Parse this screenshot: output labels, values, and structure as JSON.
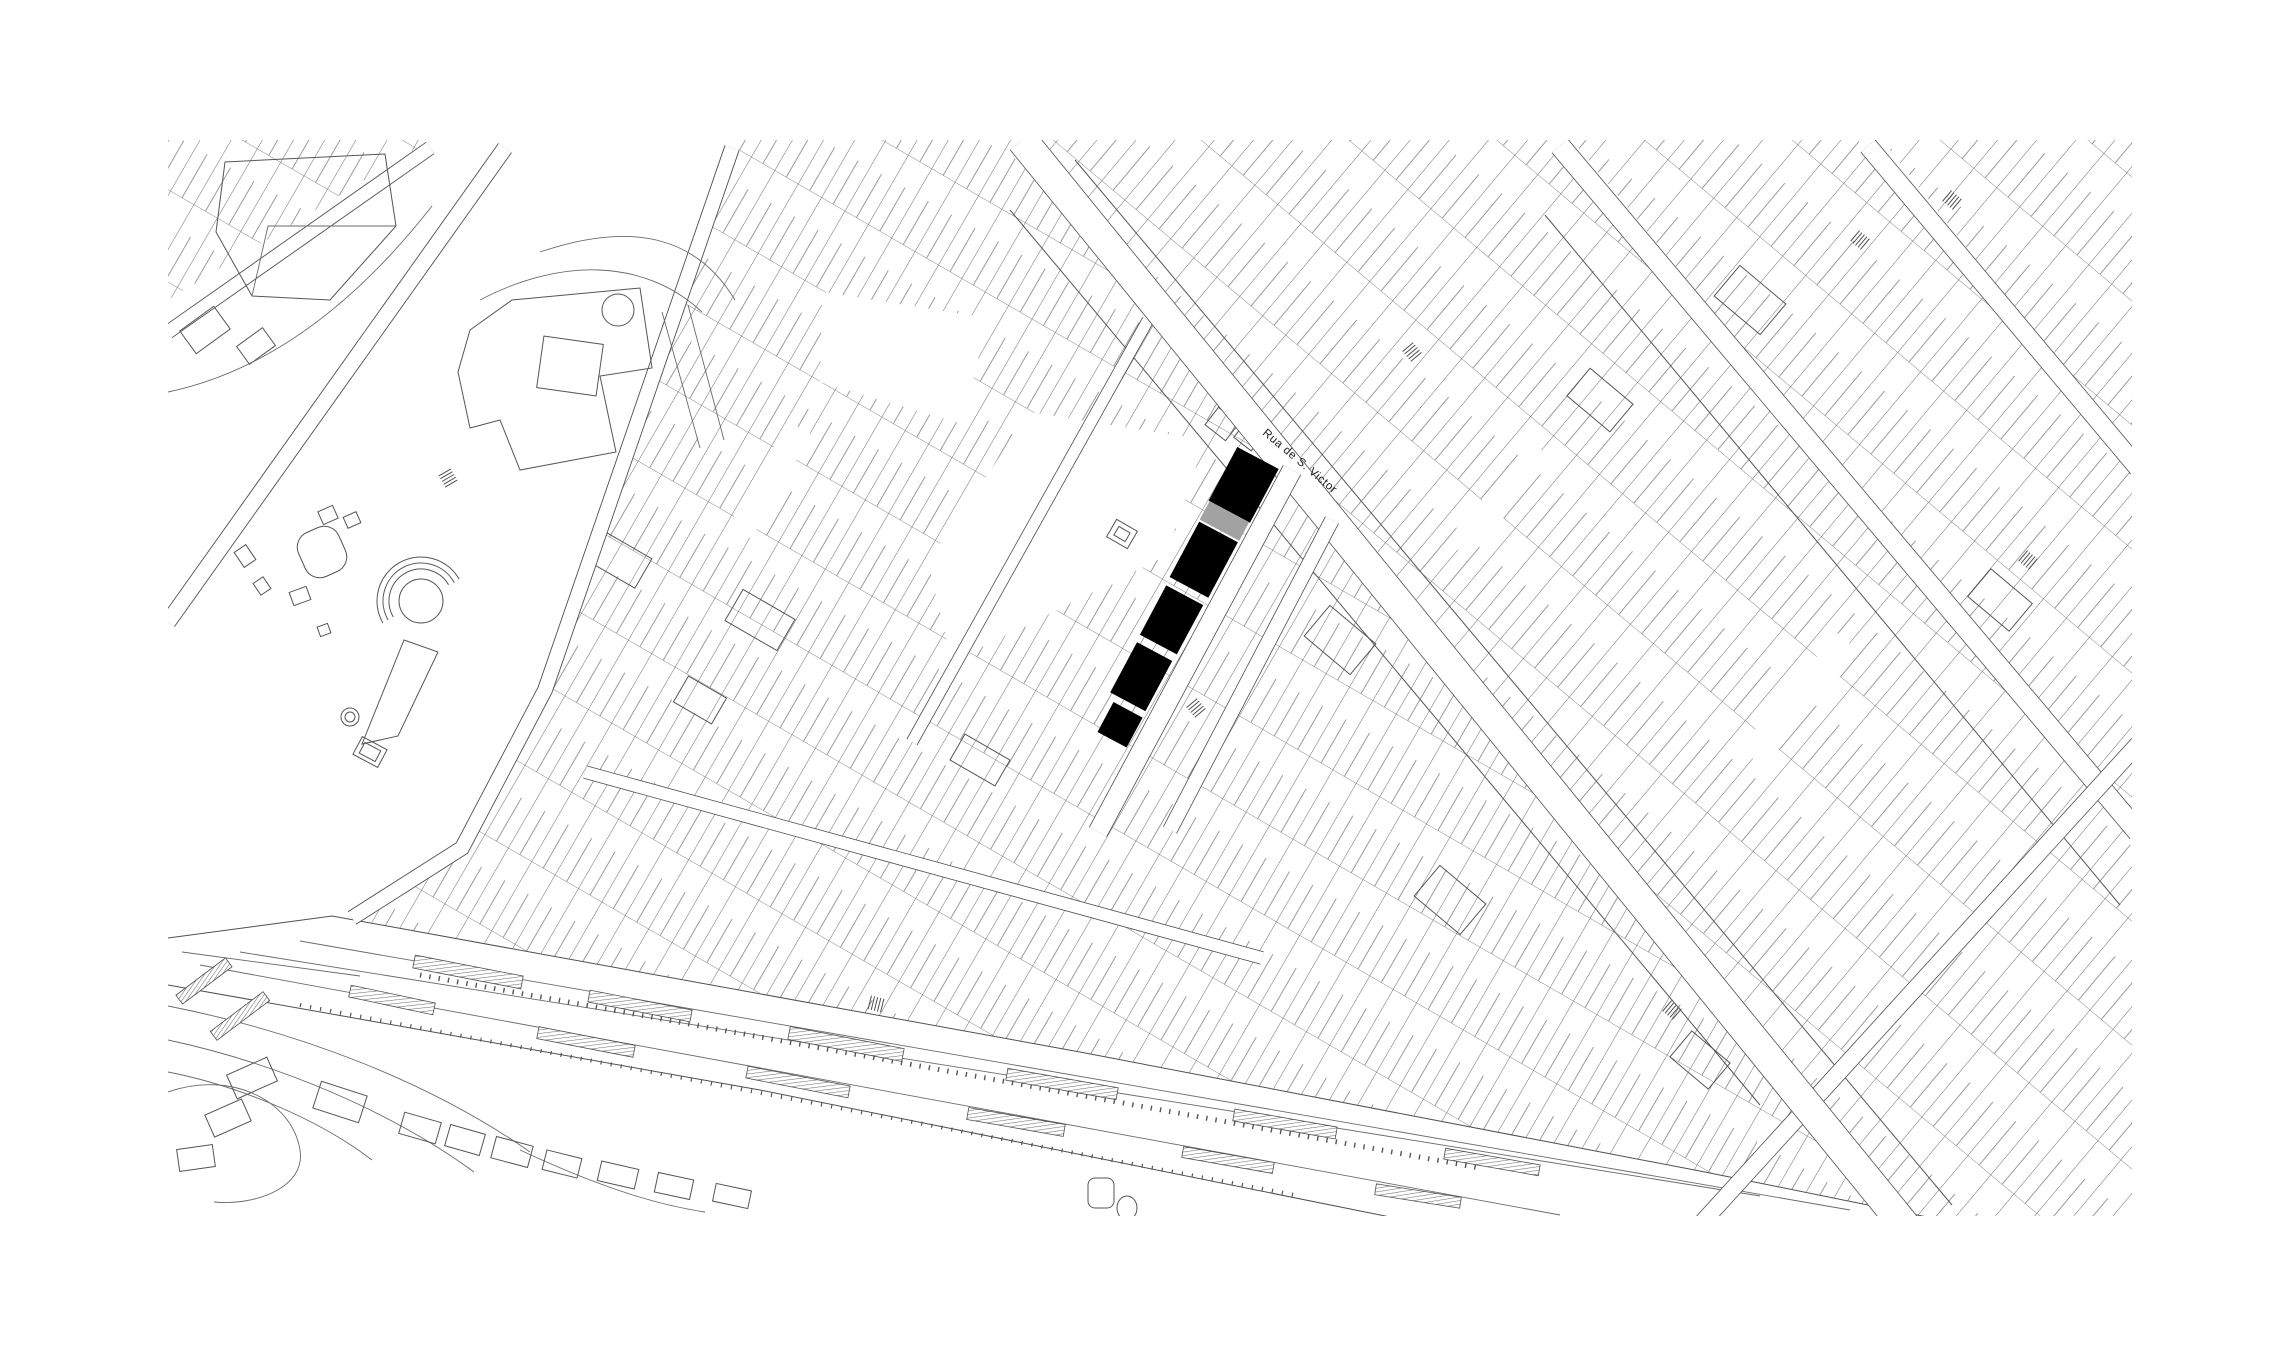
{
  "document": {
    "kind": "site-location-plan",
    "background": "#ffffff"
  },
  "map": {
    "line_color": "#4f4f4f",
    "parcel_line_color": "#5c5c5c",
    "terrain_line_color": "#6a6a6a",
    "street_label": {
      "text": "Rua de S. Victor",
      "x": 1262,
      "y": 434,
      "rotation": 40,
      "font_size": 11.5,
      "letter_spacing": 0.6,
      "color": "#1b1b1b"
    },
    "highlight_strip": {
      "black": "#000000",
      "gray": "#a2a2a2",
      "origin": {
        "x": 1258,
        "y": 458
      },
      "dir": {
        "x": -0.47,
        "y": 0.88
      },
      "perp": {
        "x": 0.88,
        "y": 0.47
      },
      "segments": [
        {
          "s0": 0,
          "s1": 61,
          "w": 47,
          "off": 0,
          "tone": "black"
        },
        {
          "s0": 61,
          "s1": 82,
          "w": 45,
          "off": 0,
          "tone": "gray"
        },
        {
          "s0": 84,
          "s1": 147,
          "w": 44,
          "off": 0,
          "tone": "black"
        },
        {
          "s0": 156,
          "s1": 212,
          "w": 42,
          "off": 0,
          "tone": "black"
        },
        {
          "s0": 220,
          "s1": 277,
          "w": 40,
          "off": 0,
          "tone": "black"
        },
        {
          "s0": 284,
          "s1": 318,
          "w": 33,
          "off": 4,
          "tone": "black"
        }
      ]
    },
    "railway_platforms": {
      "hatch_color": "#6f6f6f",
      "outline_color": "#4f4f4f",
      "items": [
        {
          "x": 468,
          "y": 972,
          "len": 110,
          "w": 13,
          "rot": 11
        },
        {
          "x": 640,
          "y": 1006,
          "len": 104,
          "w": 12,
          "rot": 11
        },
        {
          "x": 846,
          "y": 1044,
          "len": 116,
          "w": 13,
          "rot": 11
        },
        {
          "x": 1062,
          "y": 1084,
          "len": 112,
          "w": 12,
          "rot": 10
        },
        {
          "x": 1285,
          "y": 1124,
          "len": 104,
          "w": 12,
          "rot": 10
        },
        {
          "x": 1492,
          "y": 1162,
          "len": 96,
          "w": 11,
          "rot": 10
        },
        {
          "x": 392,
          "y": 1000,
          "len": 86,
          "w": 12,
          "rot": 12
        },
        {
          "x": 586,
          "y": 1042,
          "len": 98,
          "w": 12,
          "rot": 11
        },
        {
          "x": 798,
          "y": 1082,
          "len": 104,
          "w": 12,
          "rot": 11
        },
        {
          "x": 1016,
          "y": 1122,
          "len": 98,
          "w": 12,
          "rot": 10
        },
        {
          "x": 1228,
          "y": 1160,
          "len": 92,
          "w": 11,
          "rot": 10
        },
        {
          "x": 1418,
          "y": 1196,
          "len": 86,
          "w": 11,
          "rot": 9
        },
        {
          "x": 204,
          "y": 981,
          "len": 62,
          "w": 11,
          "rot": -37
        },
        {
          "x": 240,
          "y": 1016,
          "len": 66,
          "w": 11,
          "rot": -37
        }
      ]
    },
    "stair_glyphs": [
      {
        "x": 1412,
        "y": 352,
        "rot": 50
      },
      {
        "x": 1196,
        "y": 708,
        "rot": 50
      },
      {
        "x": 876,
        "y": 1004,
        "rot": 14
      },
      {
        "x": 1672,
        "y": 1010,
        "rot": 40
      },
      {
        "x": 2028,
        "y": 560,
        "rot": 40
      },
      {
        "x": 448,
        "y": 478,
        "rot": 60
      },
      {
        "x": 1860,
        "y": 240,
        "rot": 40
      },
      {
        "x": 1952,
        "y": 200,
        "rot": 40
      }
    ]
  }
}
